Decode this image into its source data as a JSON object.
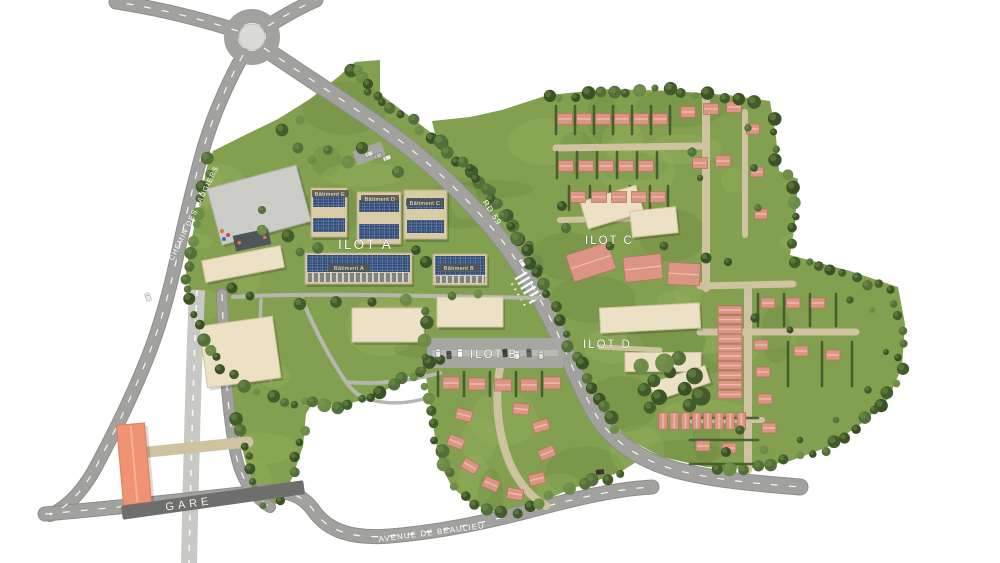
{
  "map": {
    "zones": {
      "ilot_a": "ILOT A",
      "ilot_b": "ILOT B",
      "ilot_c": "ILOT C",
      "ilot_d": "ILOT D"
    },
    "buildings": {
      "batiment_a": "Bâtiment A",
      "batiment_b": "Bâtiment B",
      "batiment_c": "Bâtiment C",
      "batiment_d": "Bâtiment D",
      "batiment_e": "Bâtiment E"
    },
    "station": {
      "gare": "GARE"
    },
    "roads": {
      "rd59": "RD 59",
      "avenue_de_beaulieu": "AVENUE DE BEAULIEU",
      "chemin_des_laugiers": "CHEMIN DES LAUGIERS"
    }
  },
  "colors": {
    "bg": "#ffffff",
    "grass": "#82a04f",
    "grass_light": "#a4bd67",
    "grass_dark": "#5d7a36",
    "tree_dark": "#425c2b",
    "tree_mid": "#53703a",
    "tree_light": "#6d8c48",
    "road": "#a1a19e",
    "road_edge": "#8d8d8a",
    "road_dark": "#717170",
    "rail": "#c8c8c4",
    "path_tan": "#cfc2a0",
    "path_gray": "#b7b7b1",
    "building_cream": "#ece1c6",
    "building_cream_edge": "#d2c49e",
    "roof_pink": "#dc9485",
    "roof_pink_ridge": "#eebcab",
    "roof_pink_edge": "#b5705f",
    "solar_blue": "#2d4672",
    "gym_gray": "#cbcbc7",
    "gare_orange": "#ef9372",
    "label_bar": "#54544a"
  }
}
